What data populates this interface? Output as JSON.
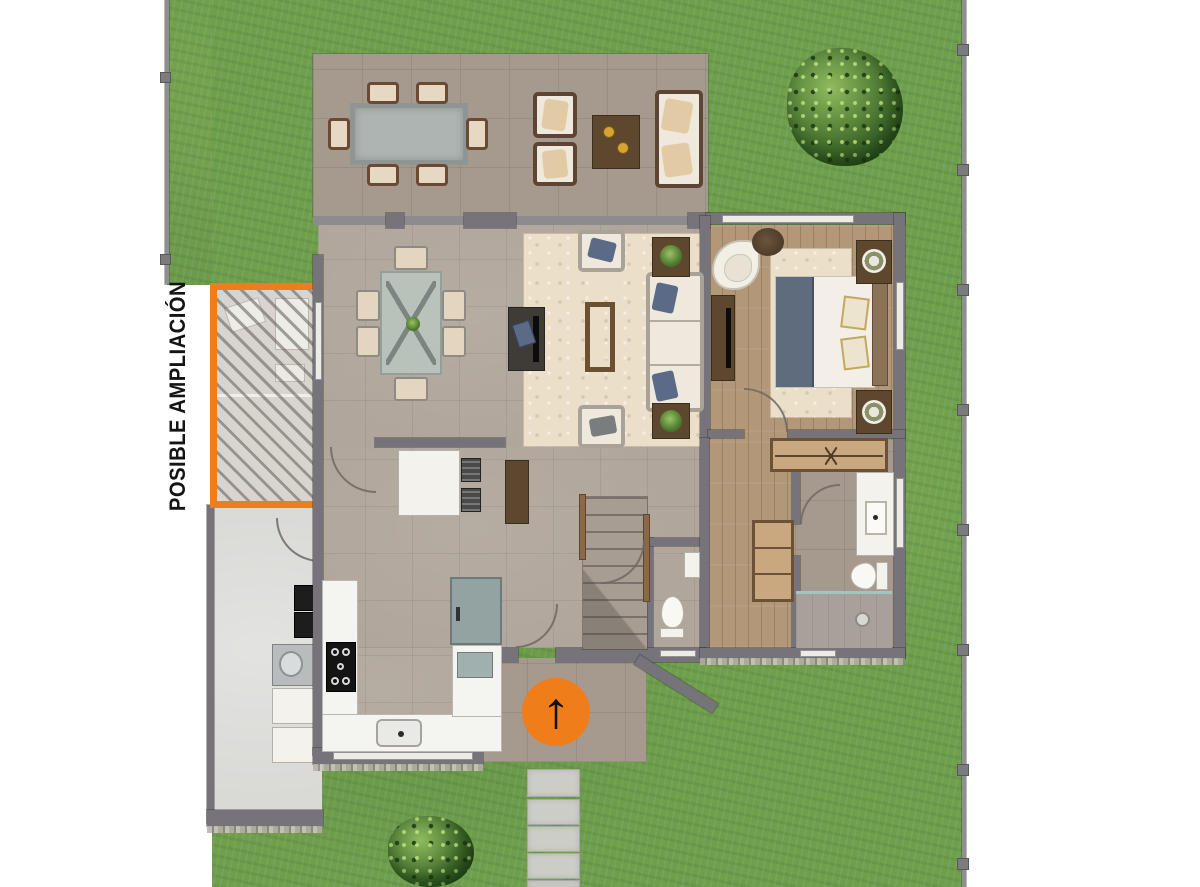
{
  "labels": {
    "expansion": "POSIBLE AMPLIACIÓN"
  },
  "icons": {
    "north_arrow": "↑"
  },
  "colors": {
    "accent_orange": "#EF7D1A",
    "lawn_green": "#6F9F4D",
    "wall_gray": "#76747A",
    "terrace_floor": "#A69A8E",
    "interior_tile": "#B0A69B",
    "bedroom_wood": "#B29878",
    "rug_cream": "#ECDFCA",
    "service_patio_floor": "#D9D9D6",
    "stepping_stone": "#CDCDC8",
    "label_text": "#141414"
  }
}
